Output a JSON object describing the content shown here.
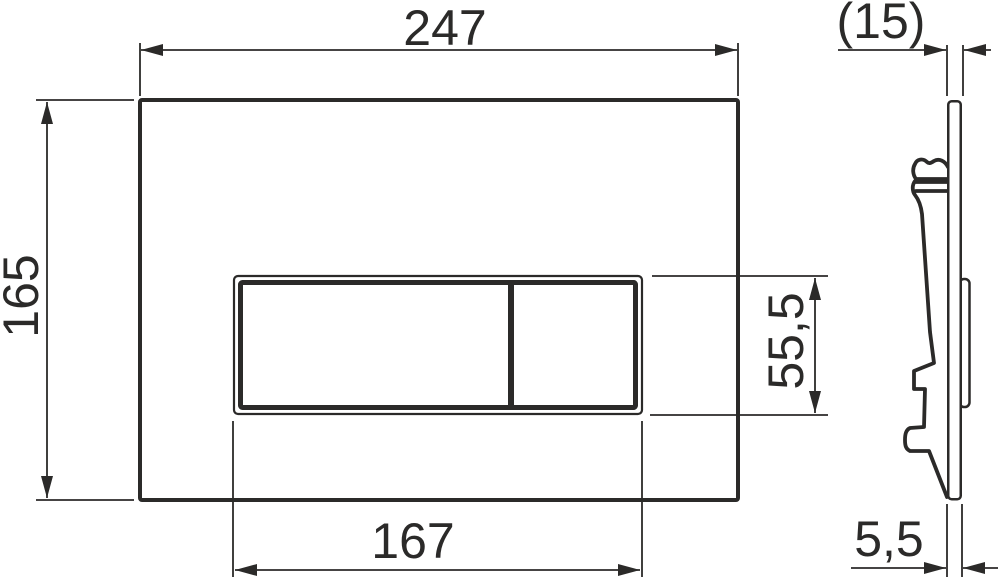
{
  "colors": {
    "line": "#2b2a29",
    "background": "#ffffff"
  },
  "front_view": {
    "dimensions": {
      "plate_width": "247",
      "plate_height": "165",
      "button_width": "167",
      "button_height": "55,5"
    }
  },
  "side_view": {
    "dimensions": {
      "depth": "(15)",
      "thickness": "5,5"
    }
  }
}
